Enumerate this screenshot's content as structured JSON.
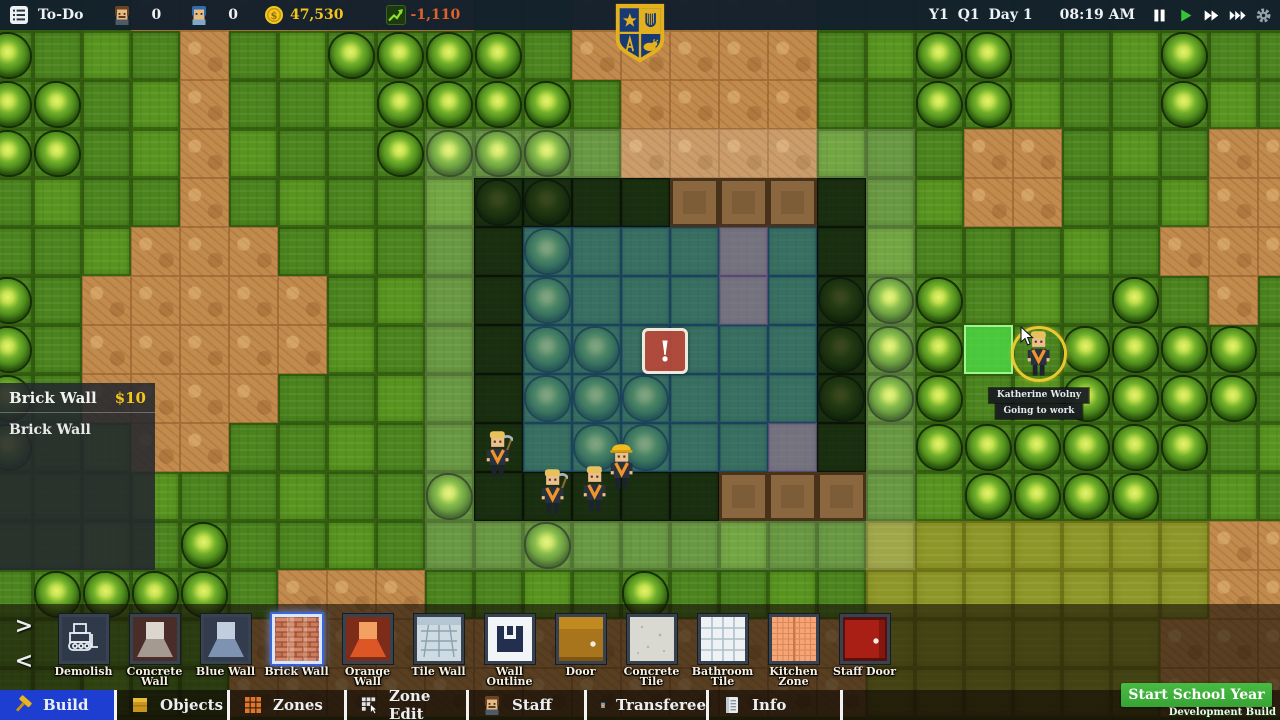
{
  "colors": {
    "topbar_bg": "#131f2b",
    "money_yellow": "#f3c51d",
    "delta_orange": "#e0622b",
    "tab_selected_blue": "#1e3ed2",
    "start_green": "#3cad39",
    "alert_red": "#b8483a",
    "blueprint_blue": "#2d5c9e",
    "blueprint_purple": "#8a6ab0",
    "grass": "#4c851e",
    "dirt": "#c28b4e",
    "highlight_tile_green": "#48dc48"
  },
  "top_bar": {
    "menu_icon": "list-icon",
    "todo_label": "To-Do",
    "teacher_icon": "teacher-icon",
    "teacher_count": "0",
    "student_icon": "student-icon",
    "student_count": "0",
    "money_icon": "coin-icon",
    "money": "47,530",
    "delta_icon": "graph-icon",
    "money_delta": "-1,110",
    "year": "Y1",
    "quarter": "Q1",
    "day": "Day 1",
    "time": "08:19 AM",
    "controls": [
      {
        "name": "pause-button",
        "icon": "pause-icon"
      },
      {
        "name": "play-button",
        "icon": "play-icon"
      },
      {
        "name": "fast-forward-button",
        "icon": "ffwd-icon"
      },
      {
        "name": "fastest-forward-button",
        "icon": "fffwd-icon"
      },
      {
        "name": "settings-button",
        "icon": "gear-icon"
      }
    ]
  },
  "logo": {
    "name": "school-crest"
  },
  "selection_panel": {
    "title": "Brick Wall",
    "price": "$10",
    "description": "Brick Wall"
  },
  "map": {
    "tile_size": 49,
    "offset_x": -16,
    "offset_y": -18,
    "legend": {
      "g": "grass",
      "h": "grass-light",
      "d": "dirt",
      "y": "olive-grass",
      "b": "bush-on-grass",
      "B": "bush-on-dirt"
    },
    "grid": [
      "gggdddddddggdddddgggggggggg",
      "bghgdghbbbbgdddddghbbgghbgg",
      "bbghdgghbbbbgddddggbbhggbhg",
      "bbghdhggbbbbgddddhggddghgdd",
      "ghggdghgghbbggdddgghddgghdd",
      "gghdddghgggbgggggghggghgddd",
      "bgdddddghggbgggggbbbghgbgdg",
      "bgdddddhgggbbggggbbbhgbbbbg",
      "bgddddgghggbbbgggbbbghbbbbg",
      "bghddgghggggbbgggggbbbbbbgh",
      "ggghgghggbgggggdddghbbbbghg",
      "gghgbgghgggbggghggyyyyyyydd",
      "gbbbbgdddgghgbgghgyyyyyyydd",
      "ggghgdddddddddddddyyyyyyddd",
      "gghggdddddddddddddyyyyyyddd"
    ],
    "building": {
      "col": 10,
      "row": 4,
      "cols": 8,
      "rows": 7,
      "brown_wall_cells": [
        [
          14,
          4
        ],
        [
          15,
          4
        ],
        [
          16,
          4
        ],
        [
          15,
          10
        ],
        [
          16,
          10
        ],
        [
          17,
          10
        ]
      ],
      "purple_floor_cells": [
        [
          15,
          5
        ],
        [
          15,
          6
        ],
        [
          16,
          9
        ]
      ],
      "ghost_ring": {
        "col": 9,
        "row": 3,
        "cols": 10,
        "rows": 9
      }
    },
    "alert": {
      "x": 642,
      "y": 328,
      "label": "!"
    },
    "selected_tile": {
      "x": 964,
      "y": 325
    },
    "workers": [
      {
        "x": 483,
        "y": 430,
        "hat": false,
        "tool": true
      },
      {
        "x": 538,
        "y": 468,
        "hat": false,
        "tool": true
      },
      {
        "x": 580,
        "y": 465,
        "hat": false,
        "tool": false
      },
      {
        "x": 607,
        "y": 443,
        "hat": true,
        "tool": false
      }
    ],
    "character": {
      "x": 1024,
      "y": 330,
      "hat": false,
      "ring_x": 1011,
      "ring_y": 326,
      "ring_size": 56
    },
    "cursor": {
      "x": 1020,
      "y": 326
    }
  },
  "tooltip": {
    "x": 1039,
    "name_y": 388,
    "status_y": 404,
    "name": "Katherine Wolny",
    "status": "Going to work"
  },
  "toolbar": {
    "arrow_next": ">",
    "arrow_prev": "<",
    "items": [
      {
        "label": "Demolish",
        "icon": "demolish-icon",
        "selected": false
      },
      {
        "label": "Concrete Wall",
        "icon": "concrete-wall-icon",
        "selected": false
      },
      {
        "label": "Blue Wall",
        "icon": "blue-wall-icon",
        "selected": false
      },
      {
        "label": "Brick Wall",
        "icon": "brick-wall-icon",
        "selected": true
      },
      {
        "label": "Orange Wall",
        "icon": "orange-wall-icon",
        "selected": false
      },
      {
        "label": "Tile Wall",
        "icon": "tile-wall-icon",
        "selected": false
      },
      {
        "label": "Wall Outline",
        "icon": "wall-outline-icon",
        "selected": false
      },
      {
        "label": "Door",
        "icon": "door-icon",
        "selected": false
      },
      {
        "label": "Concrete Tile",
        "icon": "concrete-tile-icon",
        "selected": false
      },
      {
        "label": "Bathroom Tile",
        "icon": "bathroom-tile-icon",
        "selected": false
      },
      {
        "label": "Kitchen Zone",
        "icon": "kitchen-zone-icon",
        "selected": false
      },
      {
        "label": "Staff Door",
        "icon": "staff-door-icon",
        "selected": false
      }
    ]
  },
  "tabs": [
    {
      "label": "Build",
      "icon": "hammer-icon",
      "selected": true
    },
    {
      "label": "Objects",
      "icon": "box-icon",
      "selected": false
    },
    {
      "label": "Zones",
      "icon": "zones-grid-icon",
      "selected": false
    },
    {
      "label": "Zone Edit",
      "icon": "zone-edit-icon",
      "selected": false
    },
    {
      "label": "Staff",
      "icon": "staff-person-icon",
      "selected": false
    },
    {
      "label": "Transferee",
      "icon": "transferee-person-icon",
      "selected": false
    },
    {
      "label": "Info",
      "icon": "info-doc-icon",
      "selected": false
    }
  ],
  "start_school_year": {
    "label": "Start School Year"
  },
  "dev_build_label": "Development Build"
}
